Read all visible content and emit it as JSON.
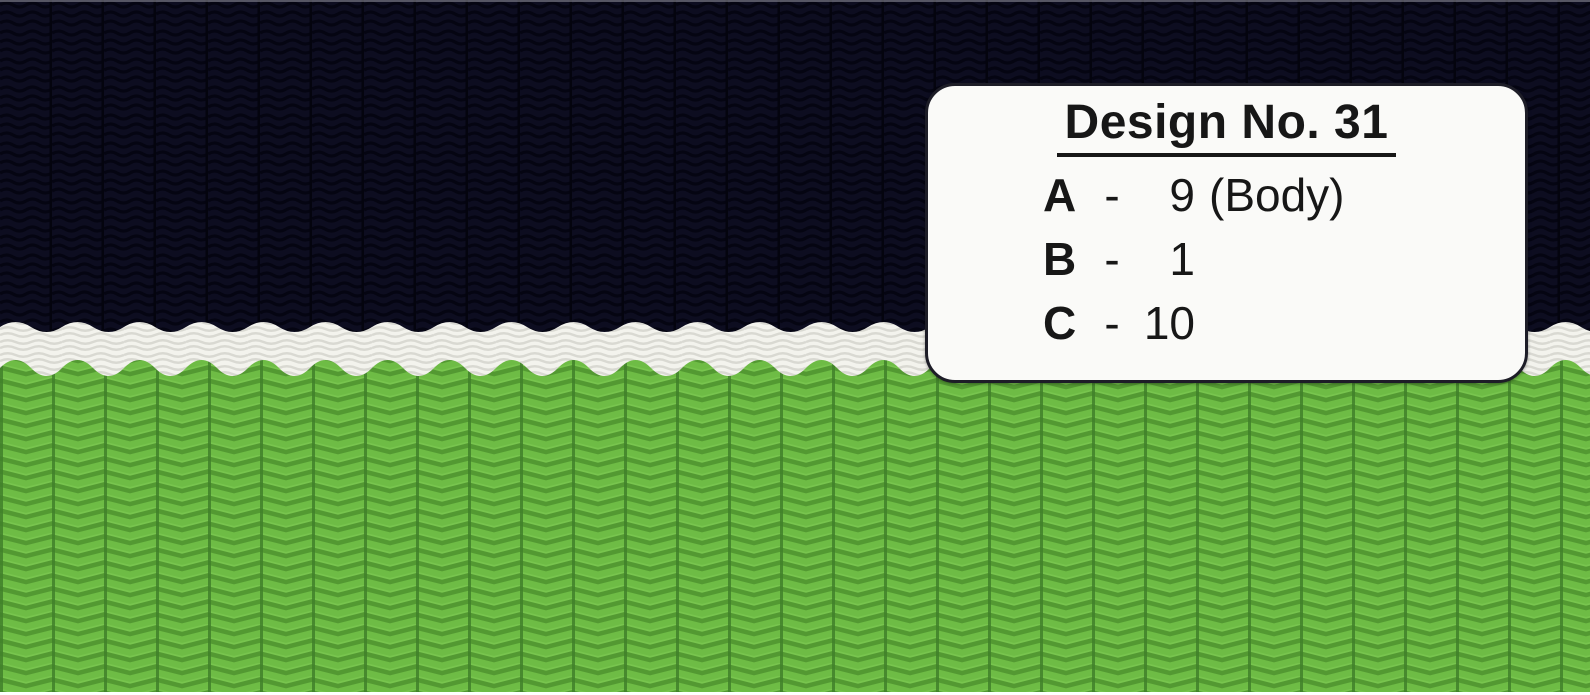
{
  "card": {
    "title": "Design No. 31",
    "rows": [
      {
        "label": "A",
        "separator": "-",
        "number": "9",
        "note": "(Body)"
      },
      {
        "label": "B",
        "separator": "-",
        "number": "1",
        "note": ""
      },
      {
        "label": "C",
        "separator": "-",
        "number": "10",
        "note": ""
      }
    ]
  },
  "colors": {
    "navy_base": "#0d0d20",
    "navy_wave": "#050512",
    "navy_rib": "#04040e",
    "green_base": "#6ebc45",
    "green_chevron": "#539932",
    "green_rib": "#41802a",
    "green_highlight": "#80cc55",
    "band_base": "#f3f3ed",
    "band_wave": "#d9d9d2",
    "card_bg": "#fafaf8",
    "card_border": "#1d1d27",
    "text": "#171717",
    "top_edge": "#94949c",
    "bottom_edge": "#ffffff"
  }
}
